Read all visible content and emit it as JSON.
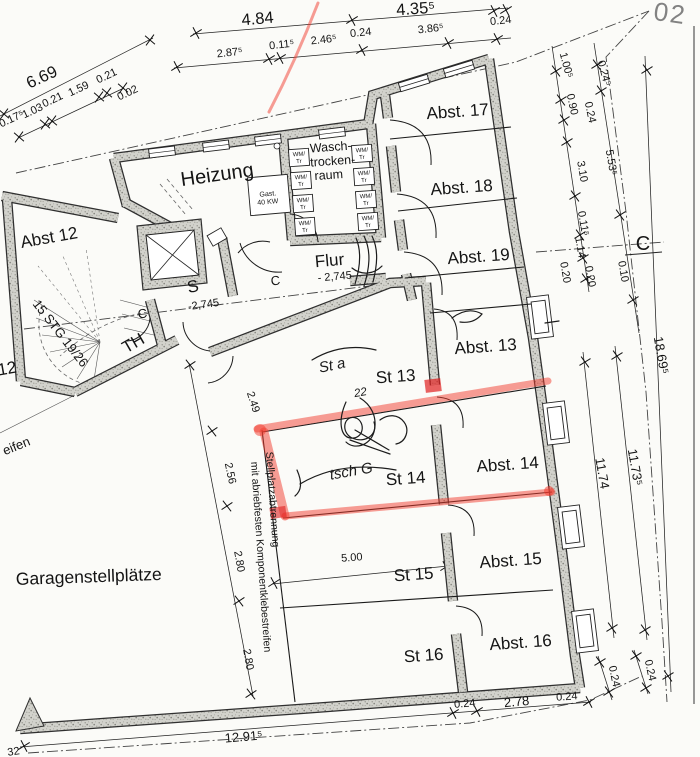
{
  "drawing": {
    "kind": "architectural basement floor plan",
    "sheet_corner_mark": "02",
    "highlight_note": "stall St 14 outlined with red marker",
    "colors": {
      "marker_red": "#f23b2e",
      "paper": "#fbfbf8",
      "wall_fill": "#d2d2cc"
    }
  },
  "labels": [
    {
      "n": "dim-6-69",
      "t": "6.69",
      "x": 44,
      "y": 82,
      "r": -25,
      "c": "dimXL"
    },
    {
      "n": "dim-0-175",
      "t": "0.17⁵",
      "x": 13,
      "y": 122,
      "r": -25,
      "c": "dim"
    },
    {
      "n": "dim-1-03",
      "t": "1.03",
      "x": 34,
      "y": 114,
      "r": -25,
      "c": "dim"
    },
    {
      "n": "dim-0-21a",
      "t": "0.21",
      "x": 54,
      "y": 103,
      "r": -25,
      "c": "dim"
    },
    {
      "n": "dim-1-59",
      "t": "1.59",
      "x": 80,
      "y": 92,
      "r": -25,
      "c": "dim"
    },
    {
      "n": "dim-0-21b",
      "t": "0.21",
      "x": 108,
      "y": 79,
      "r": -25,
      "c": "dim"
    },
    {
      "n": "dim-0-02",
      "t": "0.02",
      "x": 129,
      "y": 96,
      "r": -25,
      "c": "dim"
    },
    {
      "n": "dim-4-84",
      "t": "4.84",
      "x": 258,
      "y": 24,
      "r": -5,
      "c": "dimXL"
    },
    {
      "n": "dim-4-355",
      "t": "4.35⁵",
      "x": 416,
      "y": 14,
      "r": -4,
      "c": "dimXL"
    },
    {
      "n": "dim-2-875",
      "t": "2.87⁵",
      "x": 230,
      "y": 56,
      "r": -6,
      "c": "dim"
    },
    {
      "n": "dim-0-115",
      "t": "0.11⁵",
      "x": 282,
      "y": 48,
      "r": -6,
      "c": "dim"
    },
    {
      "n": "dim-2-465",
      "t": "2.46⁵",
      "x": 324,
      "y": 43,
      "r": -6,
      "c": "dim"
    },
    {
      "n": "dim-0-24a",
      "t": "0.24",
      "x": 361,
      "y": 36,
      "r": -6,
      "c": "dim"
    },
    {
      "n": "dim-3-865",
      "t": "3.86⁵",
      "x": 431,
      "y": 32,
      "r": -6,
      "c": "dim"
    },
    {
      "n": "dim-0-24b",
      "t": "0.24",
      "x": 501,
      "y": 24,
      "r": -6,
      "c": "dim"
    },
    {
      "n": "dim-1-005",
      "t": "1.00⁵",
      "x": 563,
      "y": 66,
      "r": 75,
      "c": "dim"
    },
    {
      "n": "dim-0-245",
      "t": "0.24⁵",
      "x": 601,
      "y": 74,
      "r": 75,
      "c": "dim"
    },
    {
      "n": "dim-0-90",
      "t": "0.90",
      "x": 569,
      "y": 105,
      "r": 78,
      "c": "dim"
    },
    {
      "n": "dim-0-24c",
      "t": "0.24",
      "x": 587,
      "y": 113,
      "r": 78,
      "c": "dim"
    },
    {
      "n": "dim-3-10",
      "t": "3.10",
      "x": 579,
      "y": 172,
      "r": 80,
      "c": "dim"
    },
    {
      "n": "dim-5-535",
      "t": "5.53⁵",
      "x": 608,
      "y": 163,
      "r": 80,
      "c": "dim"
    },
    {
      "n": "dim-0-115b",
      "t": "0.11⁵",
      "x": 580,
      "y": 224,
      "r": 80,
      "c": "dim"
    },
    {
      "n": "dim-1-14",
      "t": "1.14",
      "x": 577,
      "y": 248,
      "r": 80,
      "c": "dim"
    },
    {
      "n": "dim-0-20a",
      "t": "0.20",
      "x": 562,
      "y": 273,
      "r": 80,
      "c": "dim"
    },
    {
      "n": "dim-0-20b",
      "t": "0.20",
      "x": 587,
      "y": 277,
      "r": 80,
      "c": "dim"
    },
    {
      "n": "dim-0-10",
      "t": "0.10",
      "x": 620,
      "y": 272,
      "r": 80,
      "c": "dim"
    },
    {
      "n": "section-c-right",
      "t": "C",
      "x": 643,
      "y": 250,
      "r": 0,
      "c": "secC"
    },
    {
      "n": "dim-18-695",
      "t": "18.69⁵",
      "x": 657,
      "y": 356,
      "r": 80,
      "c": "dimL"
    },
    {
      "n": "dim-11-74",
      "t": "11.74",
      "x": 598,
      "y": 474,
      "r": 80,
      "c": "dimL"
    },
    {
      "n": "dim-11-735",
      "t": "11.73⁵",
      "x": 631,
      "y": 468,
      "r": 80,
      "c": "dimL"
    },
    {
      "n": "dim-0-24d",
      "t": "0.24",
      "x": 611,
      "y": 677,
      "r": 78,
      "c": "dim"
    },
    {
      "n": "dim-0-24e",
      "t": "0.24",
      "x": 647,
      "y": 671,
      "r": 78,
      "c": "dim"
    },
    {
      "n": "dim-12-915",
      "t": "12.91⁵",
      "x": 244,
      "y": 741,
      "r": -5,
      "c": "dimL"
    },
    {
      "n": "dim-0-24f",
      "t": "0.24",
      "x": 465,
      "y": 707,
      "r": -5,
      "c": "dim"
    },
    {
      "n": "dim-2-78",
      "t": "2.78",
      "x": 517,
      "y": 706,
      "r": -5,
      "c": "dimL"
    },
    {
      "n": "dim-0-24g",
      "t": "0.24",
      "x": 567,
      "y": 700,
      "r": -4,
      "c": "dim"
    },
    {
      "n": "dim-2-49",
      "t": "2.49",
      "x": 250,
      "y": 403,
      "r": 72,
      "c": "dim"
    },
    {
      "n": "dim-2-56",
      "t": "2.56",
      "x": 227,
      "y": 474,
      "r": 78,
      "c": "dim"
    },
    {
      "n": "dim-2-80a",
      "t": "2.80",
      "x": 236,
      "y": 562,
      "r": 80,
      "c": "dim"
    },
    {
      "n": "dim-2-80b",
      "t": "2.80",
      "x": 245,
      "y": 660,
      "r": 80,
      "c": "dim"
    },
    {
      "n": "dim-5-00",
      "t": "5.00",
      "x": 352,
      "y": 561,
      "r": -4,
      "c": "dim"
    },
    {
      "n": "room-heizung",
      "t": "Heizung",
      "x": 218,
      "y": 181,
      "r": -8,
      "c": "roomL"
    },
    {
      "n": "room-wasch-1",
      "t": "Wasch-",
      "x": 331,
      "y": 151,
      "r": -4,
      "c": "roomS"
    },
    {
      "n": "room-wasch-2",
      "t": "trocken-",
      "x": 333,
      "y": 165,
      "r": -4,
      "c": "roomS"
    },
    {
      "n": "room-wasch-3",
      "t": "raum",
      "x": 329,
      "y": 179,
      "r": -4,
      "c": "roomS"
    },
    {
      "n": "room-abst-17",
      "t": "Abst. 17",
      "x": 458,
      "y": 117,
      "r": -4,
      "c": "room"
    },
    {
      "n": "room-abst-18",
      "t": "Abst. 18",
      "x": 462,
      "y": 193,
      "r": -4,
      "c": "room"
    },
    {
      "n": "room-abst-19",
      "t": "Abst. 19",
      "x": 479,
      "y": 262,
      "r": -4,
      "c": "room"
    },
    {
      "n": "room-abst-12",
      "t": "Abst 12",
      "x": 50,
      "y": 243,
      "r": -10,
      "c": "room"
    },
    {
      "n": "room-abst-13",
      "t": "Abst. 13",
      "x": 486,
      "y": 352,
      "r": -4,
      "c": "room"
    },
    {
      "n": "room-st-13",
      "t": "St 13",
      "x": 396,
      "y": 382,
      "r": -4,
      "c": "room"
    },
    {
      "n": "room-abst-14",
      "t": "Abst. 14",
      "x": 508,
      "y": 470,
      "r": -4,
      "c": "room"
    },
    {
      "n": "room-st-14",
      "t": "St 14",
      "x": 406,
      "y": 484,
      "r": -4,
      "c": "room"
    },
    {
      "n": "room-abst-15",
      "t": "Abst. 15",
      "x": 511,
      "y": 566,
      "r": -4,
      "c": "room"
    },
    {
      "n": "room-st-15",
      "t": "St 15",
      "x": 414,
      "y": 580,
      "r": -4,
      "c": "room"
    },
    {
      "n": "room-abst-16",
      "t": "Abst. 16",
      "x": 521,
      "y": 648,
      "r": -4,
      "c": "room"
    },
    {
      "n": "room-st-16",
      "t": "St 16",
      "x": 424,
      "y": 661,
      "r": -4,
      "c": "room"
    },
    {
      "n": "room-flur",
      "t": "Flur",
      "x": 330,
      "y": 266,
      "r": -5,
      "c": "room"
    },
    {
      "n": "level-flur",
      "t": "- 2,745",
      "x": 335,
      "y": 280,
      "r": -5,
      "c": "dim"
    },
    {
      "n": "room-s",
      "t": "S",
      "x": 194,
      "y": 292,
      "r": -12,
      "c": "room"
    },
    {
      "n": "level-s",
      "t": "-2,745",
      "x": 204,
      "y": 308,
      "r": -8,
      "c": "dim"
    },
    {
      "n": "room-th",
      "t": "TH",
      "x": 136,
      "y": 348,
      "r": -30,
      "c": "room"
    },
    {
      "n": "stair-note",
      "t": "15 STG 19/26",
      "x": 57,
      "y": 336,
      "r": 52,
      "c": "dimL"
    },
    {
      "n": "section-c-mid1",
      "t": "C",
      "x": 143,
      "y": 318,
      "r": -8,
      "c": "dimL"
    },
    {
      "n": "section-c-mid2",
      "t": "C",
      "x": 276,
      "y": 285,
      "r": -8,
      "c": "dimL"
    },
    {
      "n": "area-garage",
      "t": "Garagenstellplätze",
      "x": 16,
      "y": 585,
      "r": -2,
      "c": "roomXL"
    },
    {
      "n": "note-stellplatz-1",
      "t": "Stellplatzabtrennung",
      "x": 266,
      "y": 452,
      "r": 86,
      "c": "vert"
    },
    {
      "n": "note-stellplatz-2",
      "t": "mit abriebfesten Komponentklebestreifen",
      "x": 251,
      "y": 462,
      "r": 86,
      "c": "vert"
    },
    {
      "n": "equip-gas-1",
      "t": "Gast.",
      "x": 268,
      "y": 196,
      "r": -5,
      "c": "tiny"
    },
    {
      "n": "equip-gas-2",
      "t": "40 KW",
      "x": 268,
      "y": 204,
      "r": -5,
      "c": "tiny"
    },
    {
      "n": "wm-1a",
      "t": "WM/",
      "x": 299,
      "y": 156,
      "r": -4,
      "c": "micro"
    },
    {
      "n": "wm-1b",
      "t": "Tr",
      "x": 299,
      "y": 163,
      "r": -4,
      "c": "micro"
    },
    {
      "n": "wm-2a",
      "t": "WM/",
      "x": 301,
      "y": 179,
      "r": -4,
      "c": "micro"
    },
    {
      "n": "wm-2b",
      "t": "Tr",
      "x": 301,
      "y": 186,
      "r": -4,
      "c": "micro"
    },
    {
      "n": "wm-3a",
      "t": "WM/",
      "x": 303,
      "y": 202,
      "r": -4,
      "c": "micro"
    },
    {
      "n": "wm-3b",
      "t": "Tr",
      "x": 303,
      "y": 209,
      "r": -4,
      "c": "micro"
    },
    {
      "n": "wm-4a",
      "t": "WM/",
      "x": 305,
      "y": 225,
      "r": -4,
      "c": "micro"
    },
    {
      "n": "wm-4b",
      "t": "Tr",
      "x": 305,
      "y": 232,
      "r": -4,
      "c": "micro"
    },
    {
      "n": "wm-5a",
      "t": "WM/",
      "x": 362,
      "y": 152,
      "r": -4,
      "c": "micro"
    },
    {
      "n": "wm-5b",
      "t": "Tr",
      "x": 362,
      "y": 159,
      "r": -4,
      "c": "micro"
    },
    {
      "n": "wm-6a",
      "t": "WM/",
      "x": 364,
      "y": 175,
      "r": -4,
      "c": "micro"
    },
    {
      "n": "wm-6b",
      "t": "Tr",
      "x": 364,
      "y": 182,
      "r": -4,
      "c": "micro"
    },
    {
      "n": "wm-7a",
      "t": "WM/",
      "x": 366,
      "y": 198,
      "r": -4,
      "c": "micro"
    },
    {
      "n": "wm-7b",
      "t": "Tr",
      "x": 366,
      "y": 205,
      "r": -4,
      "c": "micro"
    },
    {
      "n": "wm-8a",
      "t": "WM/",
      "x": 368,
      "y": 220,
      "r": -4,
      "c": "micro"
    },
    {
      "n": "wm-8b",
      "t": "Tr",
      "x": 368,
      "y": 227,
      "r": -4,
      "c": "micro"
    },
    {
      "n": "edge-12",
      "t": "12",
      "x": 8,
      "y": 374,
      "r": -10,
      "c": "room"
    },
    {
      "n": "edge-eifen",
      "t": "eifen",
      "x": 18,
      "y": 450,
      "r": -22,
      "c": "dimL"
    },
    {
      "n": "edge-32",
      "t": "32",
      "x": 14,
      "y": 755,
      "r": -8,
      "c": "dim"
    },
    {
      "n": "sheet-02",
      "t": "02",
      "x": 669,
      "y": 22,
      "r": 8,
      "c": "corner"
    },
    {
      "n": "hand-st-a",
      "t": "St a",
      "x": 333,
      "y": 370,
      "r": -12,
      "c": "hand"
    },
    {
      "n": "hand-22",
      "t": "22",
      "x": 361,
      "y": 396,
      "r": -10,
      "c": "handS"
    },
    {
      "n": "hand-tsch-g",
      "t": "tsch G",
      "x": 352,
      "y": 476,
      "r": -10,
      "c": "hand"
    }
  ]
}
